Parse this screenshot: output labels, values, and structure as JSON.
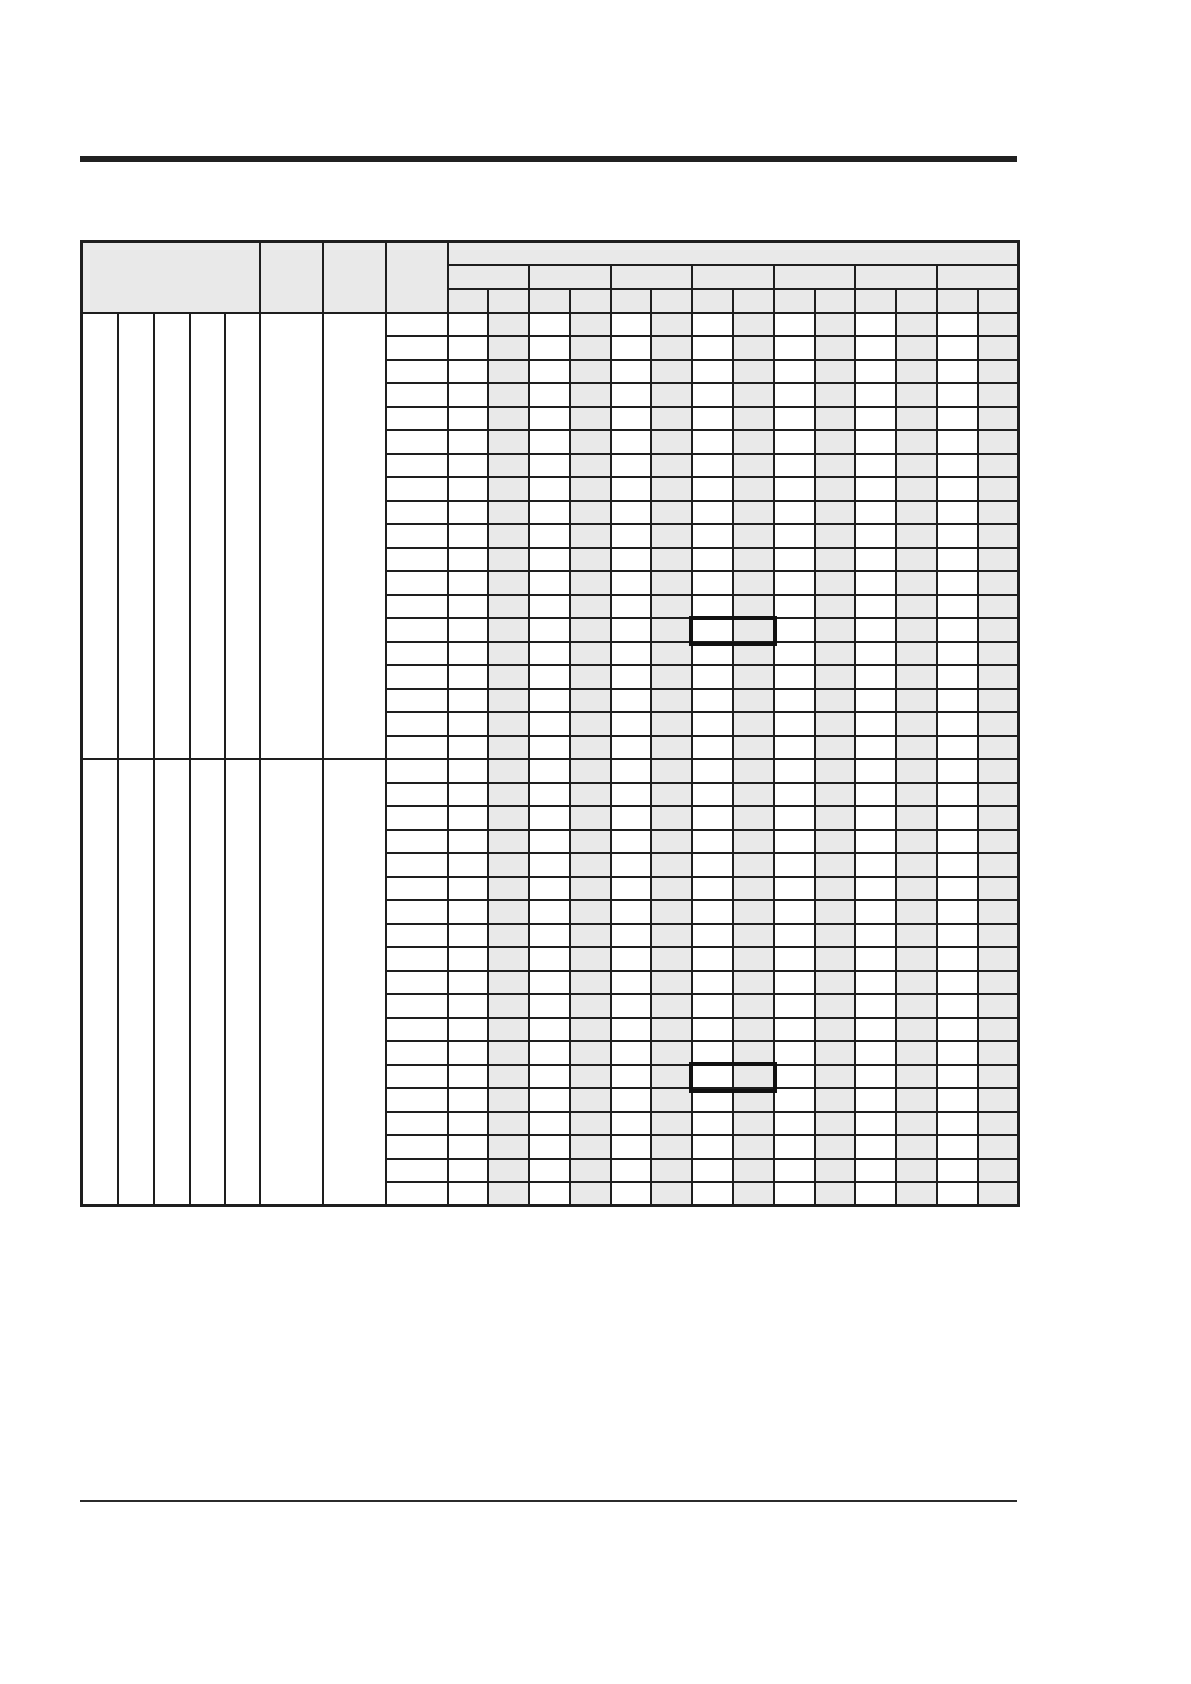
{
  "page": {
    "background": "#ffffff",
    "width": 1191,
    "height": 1684,
    "contains_text": false
  },
  "rules": {
    "top_rule": {
      "x": 80,
      "y": 156,
      "width": 937,
      "height": 6,
      "color": "#212121"
    },
    "footer_rule": {
      "x": 80,
      "y": 1500,
      "width": 937,
      "height": 2,
      "color": "#2b2b2b"
    }
  },
  "table": {
    "x": 80,
    "y": 240,
    "width": 937,
    "border_color": "#1e1e1e",
    "header_fill": "#e9e9e9",
    "shaded_fill": "#e9e9e9",
    "unshaded_fill": "#ffffff",
    "cells_empty": true,
    "cell_text": "",
    "header": {
      "row_count": 3,
      "row_height": 23.7,
      "left_merged_cells": [
        {
          "name": "left-block",
          "colspan": 5,
          "width": 178
        },
        {
          "name": "col-f",
          "colspan": 1,
          "width": 63
        },
        {
          "name": "col-g",
          "colspan": 1,
          "width": 63
        },
        {
          "name": "col-h",
          "colspan": 1,
          "width": 62
        }
      ],
      "data_header": {
        "span_width": 571,
        "group_count": 7,
        "columns_per_group": 2,
        "total_columns": 14
      }
    },
    "body": {
      "section_count": 2,
      "rows_per_section": 19,
      "row_height": 23.5,
      "narrow_column_widths": [
        36,
        36,
        36,
        35,
        35
      ],
      "left_merged_column_widths": [
        63,
        63,
        62
      ],
      "data_column_count": 14,
      "shaded_data_columns": [
        2,
        4,
        6,
        8,
        10,
        12,
        14
      ],
      "stub_column_shaded": false
    },
    "highlights": {
      "border_color": "#111111",
      "border_width": 4,
      "boxes": [
        {
          "section": 1,
          "row": 14,
          "col_start": 7,
          "col_end": 8
        },
        {
          "section": 2,
          "row": 14,
          "col_start": 7,
          "col_end": 8
        }
      ]
    }
  }
}
